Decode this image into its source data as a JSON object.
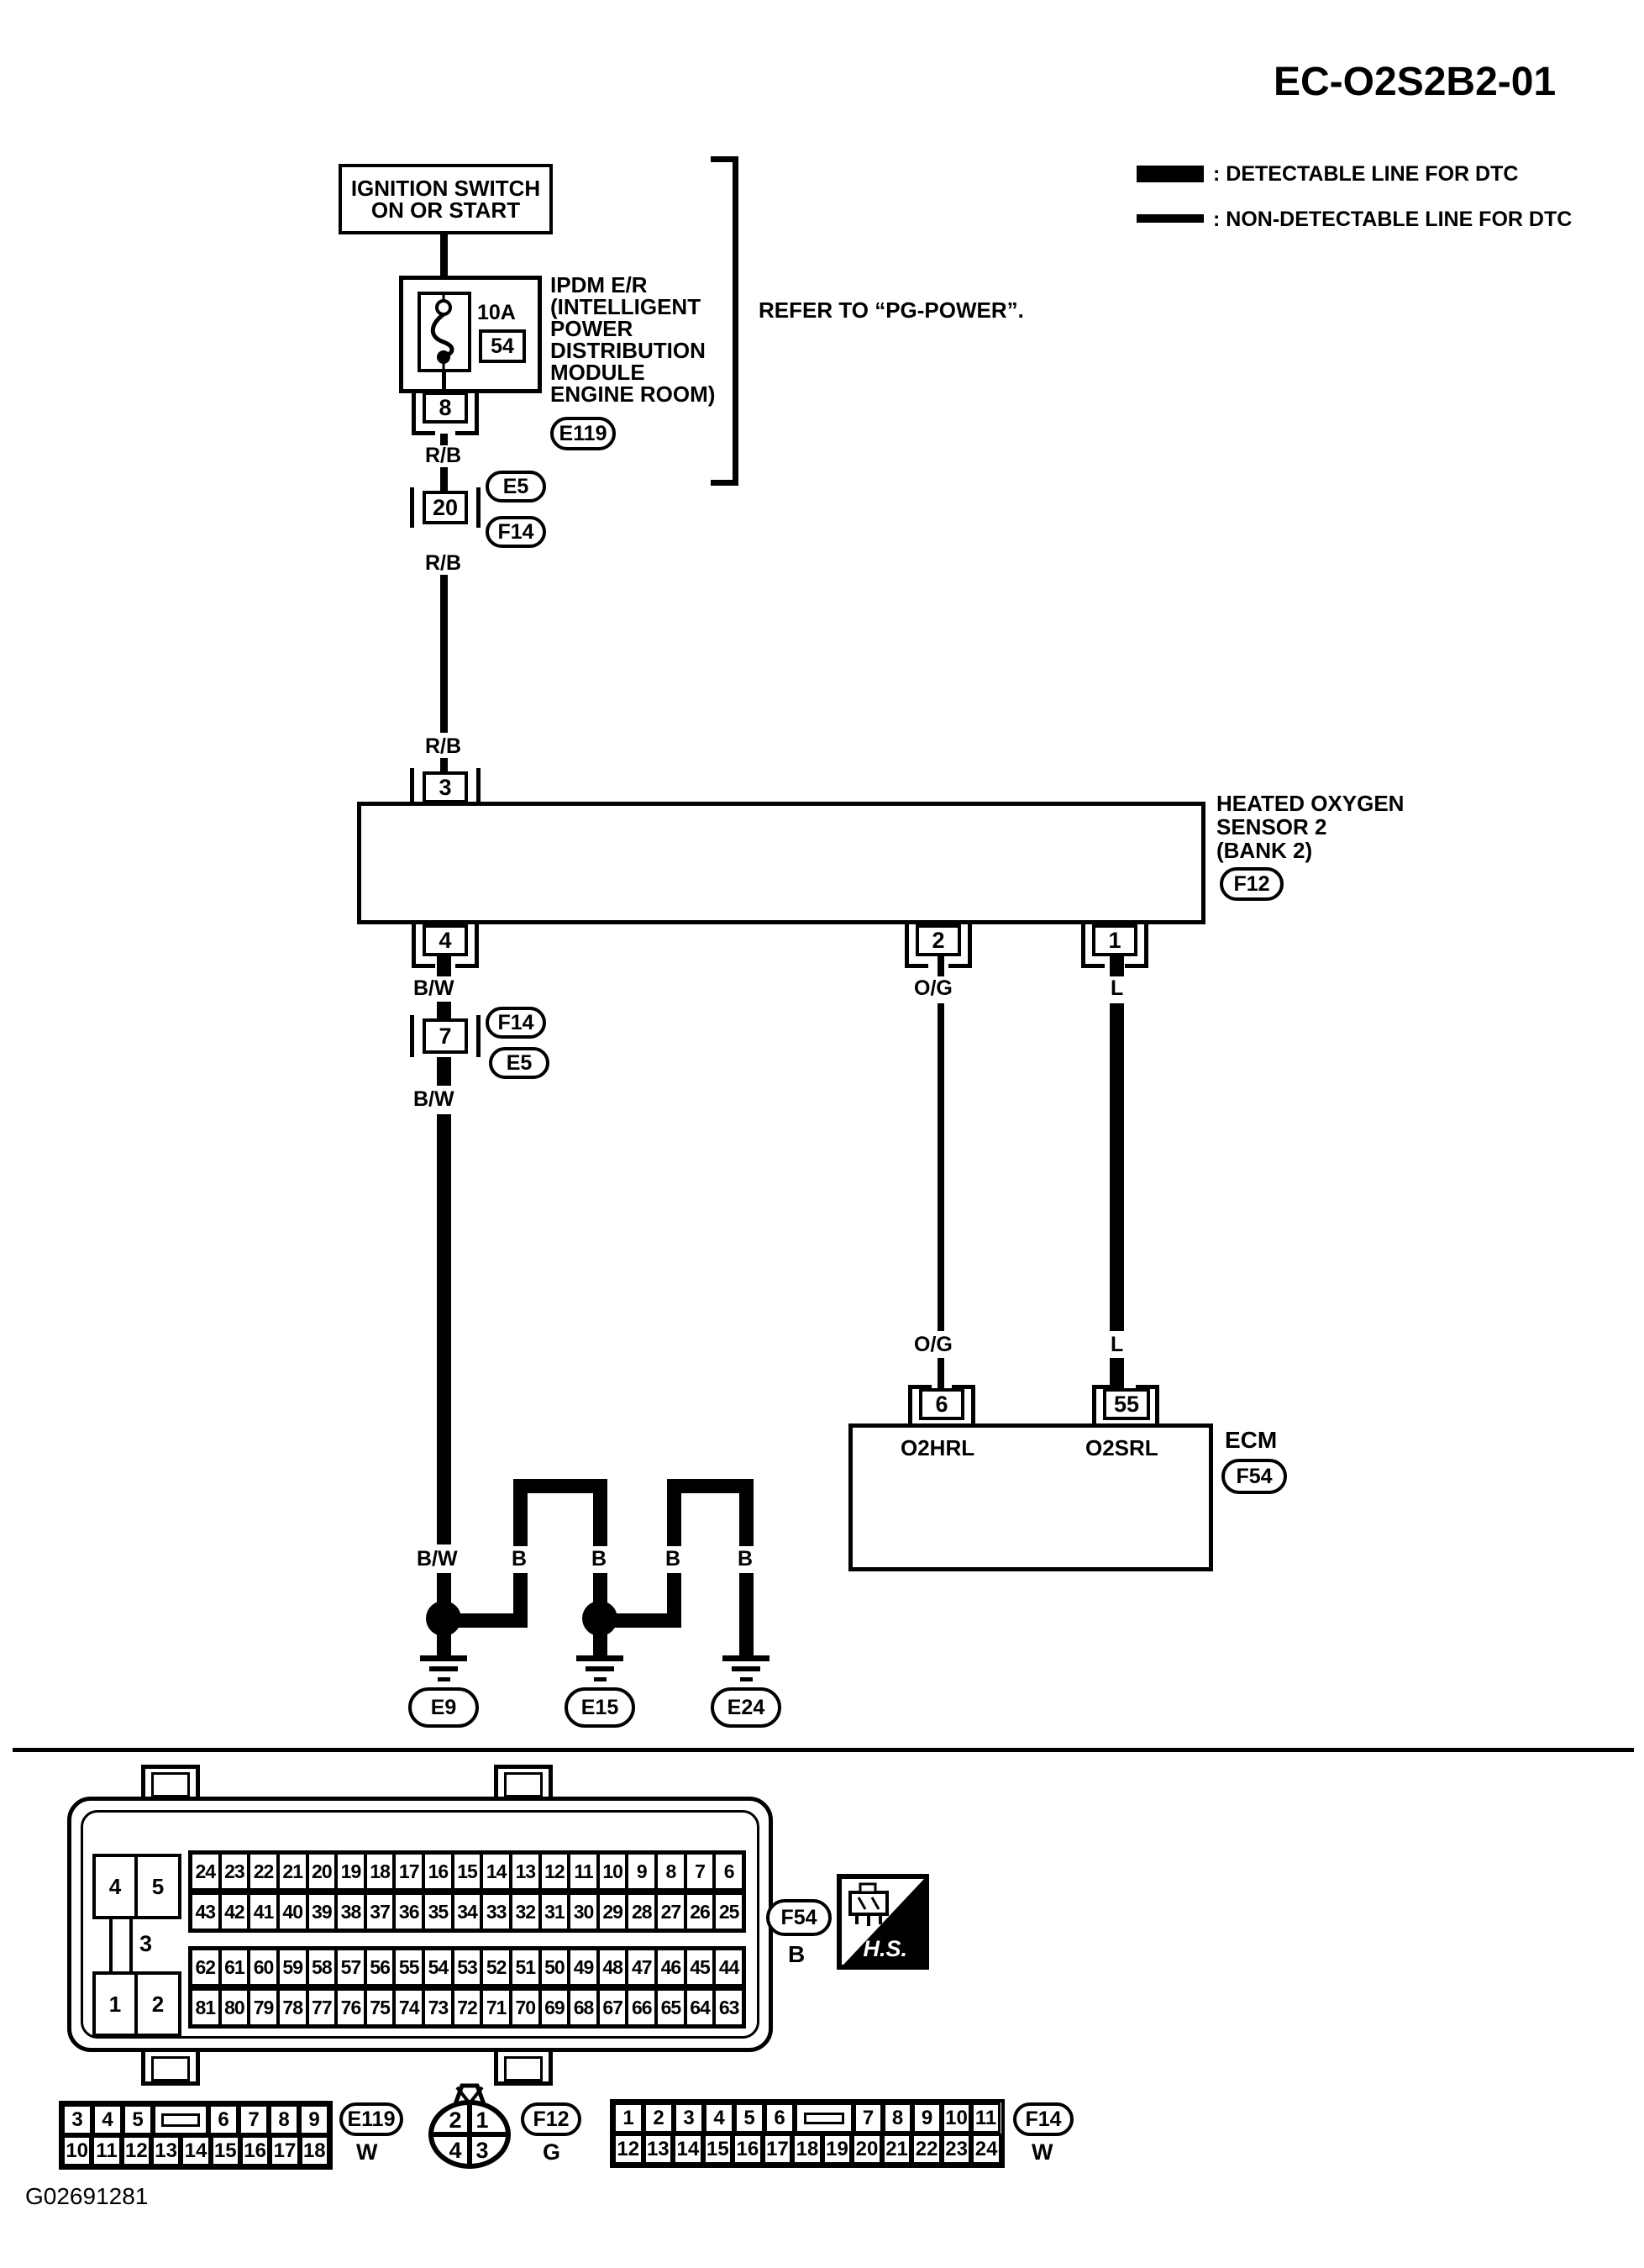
{
  "page": {
    "title": "EC-O2S2B2-01",
    "footer_code": "G02691281"
  },
  "legend": {
    "detectable": ": DETECTABLE LINE FOR DTC",
    "non_detectable": ": NON-DETECTABLE LINE FOR DTC"
  },
  "colors": {
    "ink": "#000000",
    "paper": "#ffffff"
  },
  "power": {
    "ignition_line1": "IGNITION SWITCH",
    "ignition_line2": "ON OR START",
    "fuse_rating": "10A",
    "fuse_slot": "54",
    "pin": "8",
    "ipdm_lines": [
      "IPDM E/R",
      "(INTELLIGENT",
      "POWER",
      "DISTRIBUTION",
      "MODULE",
      "ENGINE ROOM)"
    ],
    "ipdm_ref": "E119",
    "refer_note": "REFER TO “PG-POWER”."
  },
  "wires": {
    "rb": "R/B",
    "bw": "B/W",
    "og": "O/G",
    "l": "L",
    "b": "B"
  },
  "inline_connectors": {
    "c20": {
      "pin": "20",
      "refs": [
        "E5",
        "F14"
      ]
    },
    "c7": {
      "pin": "7",
      "refs": [
        "F14",
        "E5"
      ]
    }
  },
  "sensor": {
    "pin_top": "3",
    "pins_bottom": [
      "4",
      "2",
      "1"
    ],
    "name_lines": [
      "HEATED OXYGEN",
      "SENSOR 2",
      "(BANK 2)"
    ],
    "ref": "F12"
  },
  "ecm": {
    "label": "ECM",
    "ref": "F54",
    "pin_left": "6",
    "pin_left_name": "O2HRL",
    "pin_right": "55",
    "pin_right_name": "O2SRL"
  },
  "grounds": {
    "refs": [
      "E9",
      "E15",
      "E24"
    ]
  },
  "f54_view": {
    "ref": "F54",
    "color_code": "B",
    "hs": "H.S.",
    "left": {
      "top": [
        "4",
        "5"
      ],
      "mid": "3",
      "bottom": [
        "1",
        "2"
      ]
    },
    "top_row1": [
      "24",
      "23",
      "22",
      "21",
      "20",
      "19",
      "18",
      "17",
      "16",
      "15",
      "14",
      "13",
      "12",
      "11",
      "10",
      "9",
      "8",
      "7",
      "6"
    ],
    "top_row2": [
      "43",
      "42",
      "41",
      "40",
      "39",
      "38",
      "37",
      "36",
      "35",
      "34",
      "33",
      "32",
      "31",
      "30",
      "29",
      "28",
      "27",
      "26",
      "25"
    ],
    "bottom_row1": [
      "62",
      "61",
      "60",
      "59",
      "58",
      "57",
      "56",
      "55",
      "54",
      "53",
      "52",
      "51",
      "50",
      "49",
      "48",
      "47",
      "46",
      "45",
      "44"
    ],
    "bottom_row2": [
      "81",
      "80",
      "79",
      "78",
      "77",
      "76",
      "75",
      "74",
      "73",
      "72",
      "71",
      "70",
      "69",
      "68",
      "67",
      "66",
      "65",
      "64",
      "63"
    ]
  },
  "e119_view": {
    "ref": "E119",
    "color_code": "W",
    "top_left": [
      "3",
      "4",
      "5"
    ],
    "top_right": [
      "6",
      "7",
      "8",
      "9"
    ],
    "bottom": [
      "10",
      "11",
      "12",
      "13",
      "14",
      "15",
      "16",
      "17",
      "18"
    ]
  },
  "f12_view": {
    "ref": "F12",
    "color_code": "G",
    "quadrants": [
      "2",
      "1",
      "4",
      "3"
    ]
  },
  "f14_view": {
    "ref": "F14",
    "color_code": "W",
    "top_left": [
      "1",
      "2",
      "3",
      "4",
      "5",
      "6"
    ],
    "top_right": [
      "7",
      "8",
      "9",
      "10",
      "11"
    ],
    "bottom": [
      "12",
      "13",
      "14",
      "15",
      "16",
      "17",
      "18",
      "19",
      "20",
      "21",
      "22",
      "23",
      "24"
    ]
  }
}
